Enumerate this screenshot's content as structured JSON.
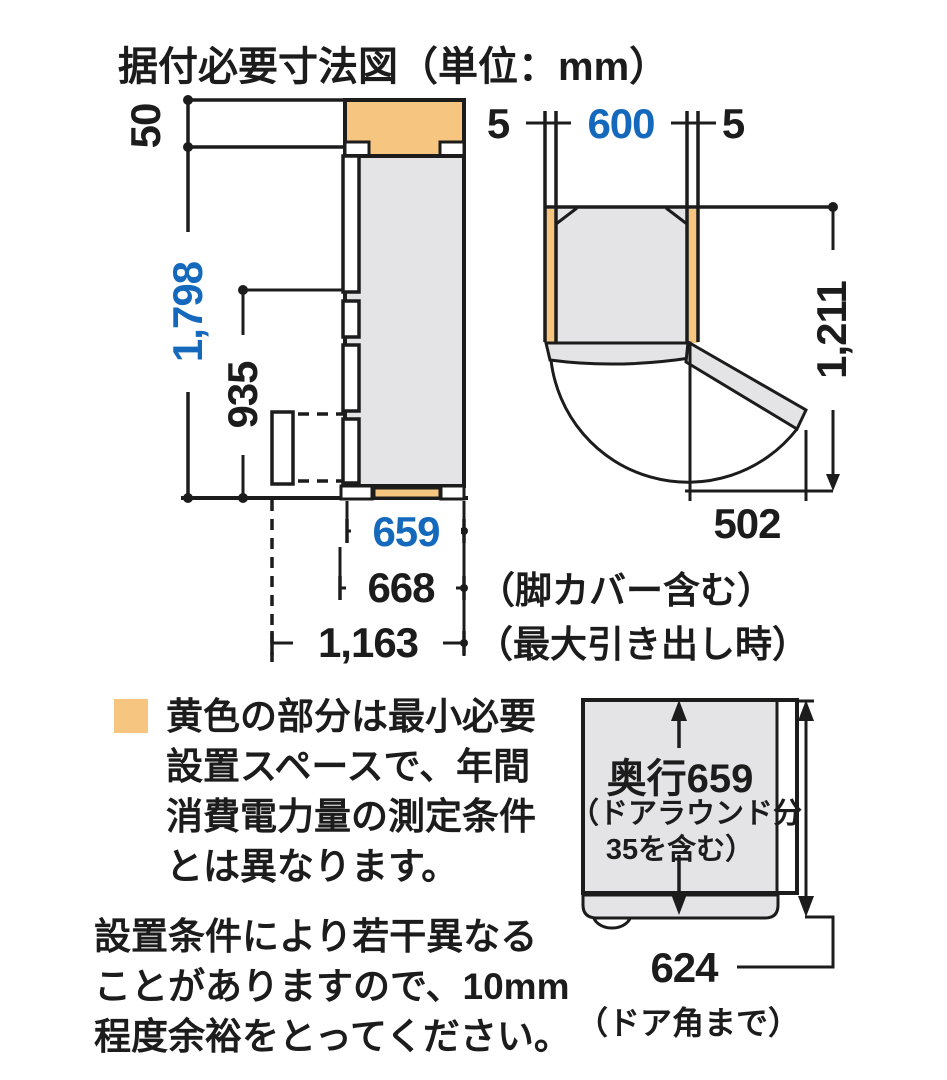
{
  "title": "据付必要寸法図（単位：mm）",
  "side_view": {
    "dim_top_clearance": "50",
    "dim_height": "1,798",
    "dim_lower_section_height": "935",
    "dim_depth_body": "659",
    "dim_depth_leg_cover": "668",
    "dim_depth_max_drawer": "1,163",
    "note_leg_cover": "（脚カバー含む）",
    "note_max_drawer": "（最大引き出し時）"
  },
  "top_view": {
    "dim_left_clearance": "5",
    "dim_width": "600",
    "dim_right_clearance": "5",
    "dim_depth_door_open": "1,211",
    "dim_door_swing": "502"
  },
  "legend": {
    "line1": "黄色の部分は最小必要",
    "line2": "設置スペースで、年間",
    "line3": "消費電力量の測定条件",
    "line4": "とは異なります。"
  },
  "caution": {
    "line1": "設置条件により若干異なる",
    "line2": "ことがありますので、10mm",
    "line3": "程度余裕をとってください。"
  },
  "depth_view": {
    "label_line1": "奥行659",
    "label_line2": "（ドアラウンド分",
    "label_line3": "35を含む）",
    "dim_door_corner": "624",
    "note_door_corner": "（ドア角まで）"
  },
  "colors": {
    "accent_blue": "#1569bd",
    "space_yellow": "#f6c57f",
    "body_gray": "#e4e4e6",
    "line_black": "#1c1c1c"
  }
}
